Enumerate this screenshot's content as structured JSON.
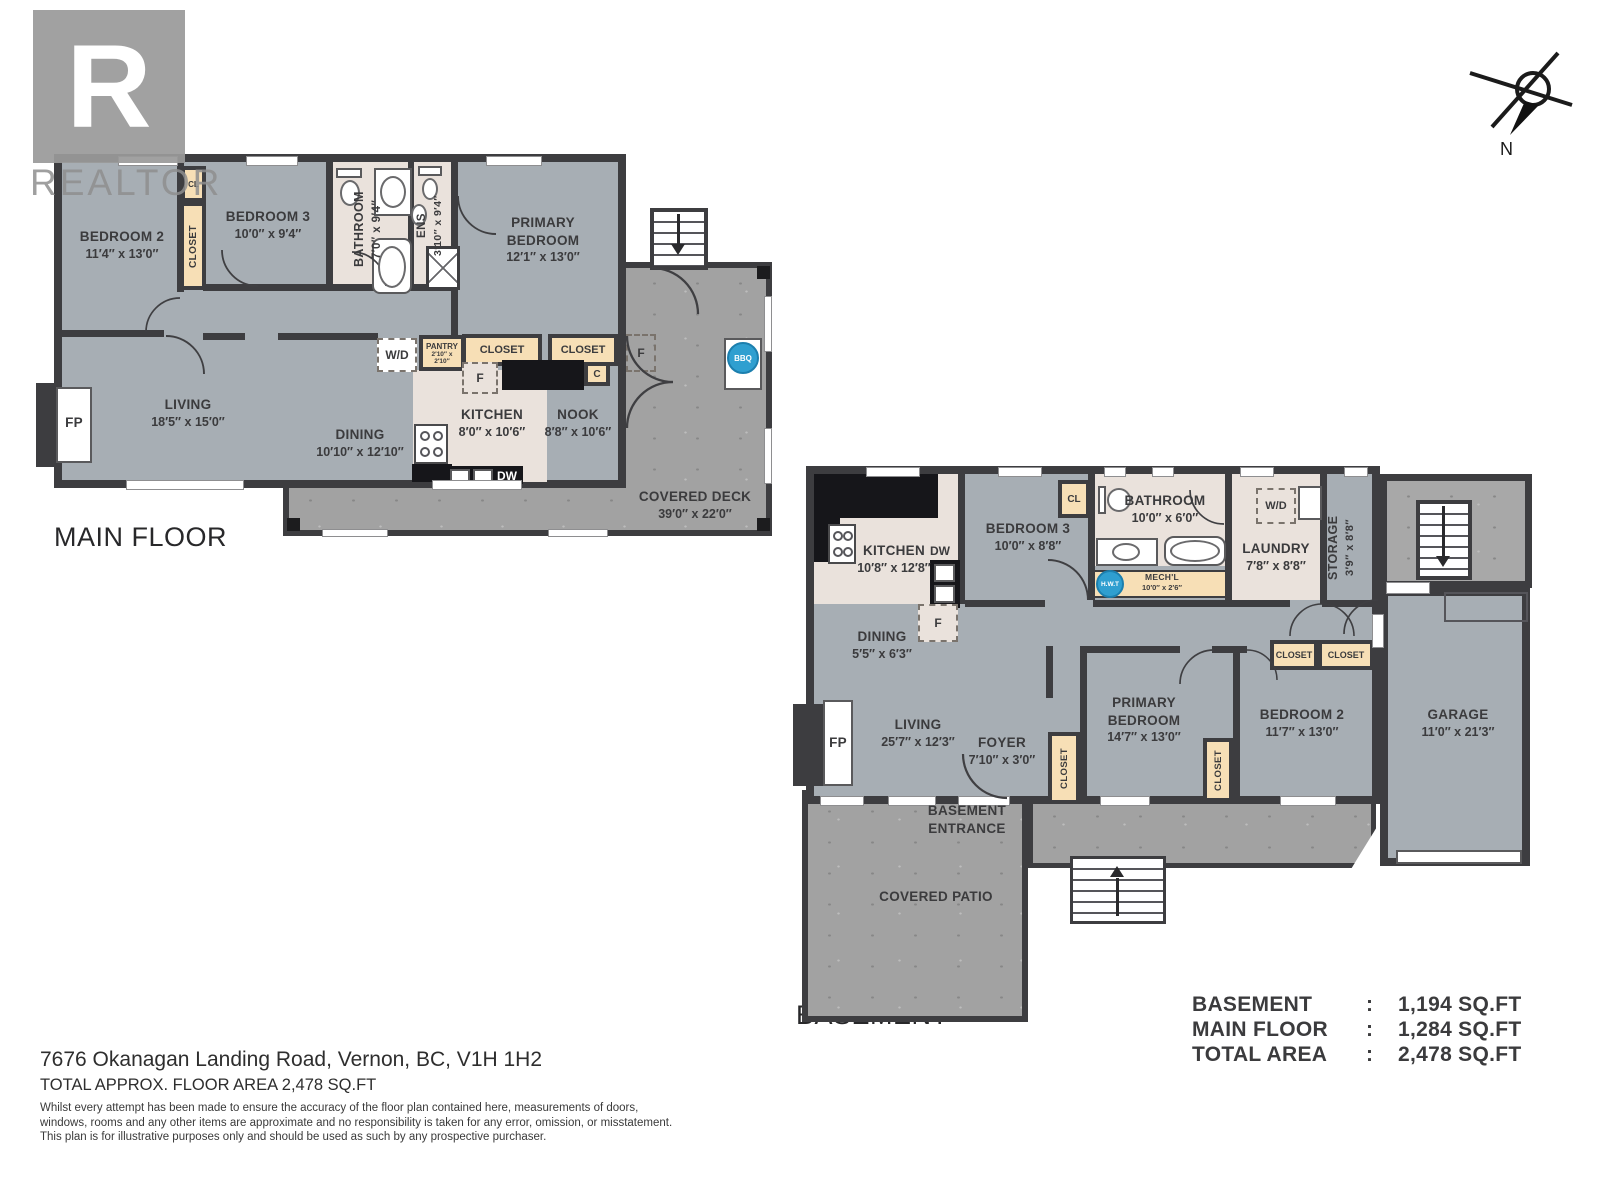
{
  "watermark": {
    "logo_letter": "R",
    "brand": "REALTOR"
  },
  "compass": {
    "north_label": "N"
  },
  "main_floor": {
    "title": "MAIN FLOOR",
    "rooms": {
      "bedroom2": {
        "name": "BEDROOM 2",
        "dims": "11′4″ x 13′0″"
      },
      "bedroom3": {
        "name": "BEDROOM 3",
        "dims": "10′0″ x 9′4″"
      },
      "bathroom": {
        "name": "BATHROOM",
        "dims": "7′0″ x 9′4″"
      },
      "ens": {
        "name": "ENS",
        "dims": "3′10″ x 9′4″"
      },
      "primary": {
        "name": "PRIMARY BEDROOM",
        "dims": "12′1″ x 13′0″"
      },
      "living": {
        "name": "LIVING",
        "dims": "18′5″ x 15′0″"
      },
      "dining": {
        "name": "DINING",
        "dims": "10′10″ x 12′10″"
      },
      "kitchen": {
        "name": "KITCHEN",
        "dims": "8′0″ x 10′6″"
      },
      "nook": {
        "name": "NOOK",
        "dims": "8′8″ x 10′6″"
      },
      "pantry": {
        "name": "PANTRY",
        "dims": "2′10″ x 2′10″"
      },
      "deck": {
        "name": "COVERED DECK",
        "dims": "39′0″ x 22′0″"
      }
    },
    "labels": {
      "cl": "CL",
      "closet": "CLOSET",
      "closet_a": "CLOSET",
      "closet_b": "CLOSET",
      "wd": "W/D",
      "c": "C",
      "f_kitchen": "F",
      "f_deck": "F",
      "fp": "FP",
      "dw": "DW",
      "bbq": "BBQ"
    }
  },
  "basement": {
    "title": "BASEMENT",
    "rooms": {
      "kitchen": {
        "name": "KITCHEN",
        "dims": "10′8″ x 12′8″"
      },
      "bedroom3": {
        "name": "BEDROOM 3",
        "dims": "10′0″ x 8′8″"
      },
      "bathroom": {
        "name": "BATHROOM",
        "dims": "10′0″ x 6′0″"
      },
      "mechanical": {
        "name": "MECH'L",
        "dims": "10′0″ x 2′6″"
      },
      "laundry": {
        "name": "LAUNDRY",
        "dims": "7′8″ x 8′8″"
      },
      "storage": {
        "name": "STORAGE",
        "dims": "3′9″ x 8′8″"
      },
      "dining": {
        "name": "DINING",
        "dims": "5′5″ x 6′3″"
      },
      "living": {
        "name": "LIVING",
        "dims": "25′7″ x 12′3″"
      },
      "foyer": {
        "name": "FOYER",
        "dims": "7′10″ x 3′0″"
      },
      "primary": {
        "name": "PRIMARY BEDROOM",
        "dims": "14′7″ x 13′0″"
      },
      "bedroom2": {
        "name": "BEDROOM 2",
        "dims": "11′7″ x 13′0″"
      },
      "garage": {
        "name": "GARAGE",
        "dims": "11′0″ x 21′3″"
      },
      "patio": {
        "name": "COVERED PATIO"
      },
      "entrance": {
        "name": "BASEMENT ENTRANCE"
      }
    },
    "labels": {
      "cl": "CL",
      "closet_foyer": "CLOSET",
      "closet_primary": "CLOSET",
      "closet_a": "CLOSET",
      "closet_b": "CLOSET",
      "wd": "W/D",
      "f": "F",
      "fp": "FP",
      "dw": "DW",
      "hwt": "H.W.T"
    }
  },
  "summary": {
    "rows": [
      {
        "label": "BASEMENT",
        "sep": ":",
        "value": "1,194 SQ.FT"
      },
      {
        "label": "MAIN FLOOR",
        "sep": ":",
        "value": "1,284 SQ.FT"
      },
      {
        "label": "TOTAL AREA",
        "sep": ":",
        "value": "2,478 SQ.FT"
      }
    ]
  },
  "footer": {
    "address": "7676 Okanagan Landing Road, Vernon, BC, V1H 1H2",
    "area_line": "TOTAL APPROX. FLOOR AREA 2,478 SQ.FT",
    "disclaimer1": "Whilst every attempt has been made to ensure the accuracy of the floor plan contained here, measurements of doors,",
    "disclaimer2": "windows, rooms and any other items are approximate and no responsibility is taken for any error, omission, or misstatement.",
    "disclaimer3": "This plan is for illustrative purposes only and should be used as such by any prospective purchaser."
  },
  "colors": {
    "wall": "#3d3d40",
    "room_fill": "#a7aeb4",
    "closet_fill": "#f7dfb6",
    "bath_floor": "#eae2dc",
    "deck_gray": "#a2a2a2",
    "appliance_blue": "#2f9fd0"
  }
}
